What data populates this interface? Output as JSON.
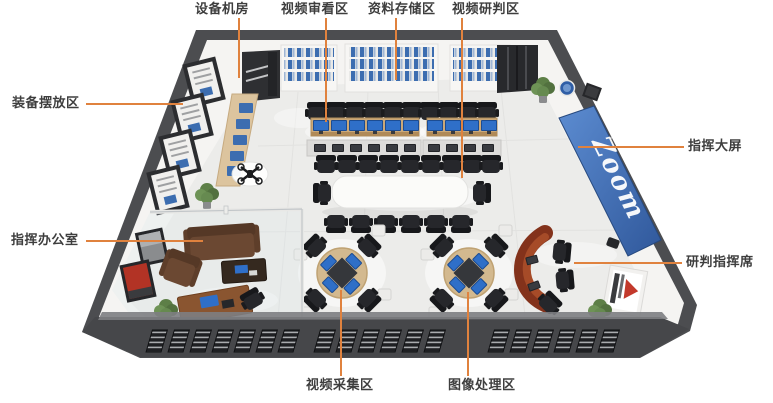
{
  "scene": {
    "type": "isometric 3D floor plan rendering of a video command center",
    "background_color": "#FFFFFF"
  },
  "callouts": {
    "line_color": "#E0823E",
    "text_color": "#3E3E3E",
    "equipment_room": "设备机房",
    "video_review": "视频审看区",
    "data_storage": "资料存储区",
    "video_judgement": "视频研判区",
    "equipment_display": "装备摆放区",
    "command_screen": "指挥大屏",
    "command_office": "指挥办公室",
    "judgement_command_seat": "研判指挥席",
    "video_capture": "视频采集区",
    "image_processing": "图像处理区"
  },
  "screen": {
    "logo_text": "Zoom",
    "panel_color": "#3E6DB3"
  },
  "palette": {
    "wall_dark": "#4C4D50",
    "floor": "#ECECEA",
    "monitor_blue": "#2F6FC8",
    "desk_wood": "#CBA878",
    "sofa_brown": "#6A4832",
    "reception_desk": "#83321B"
  }
}
